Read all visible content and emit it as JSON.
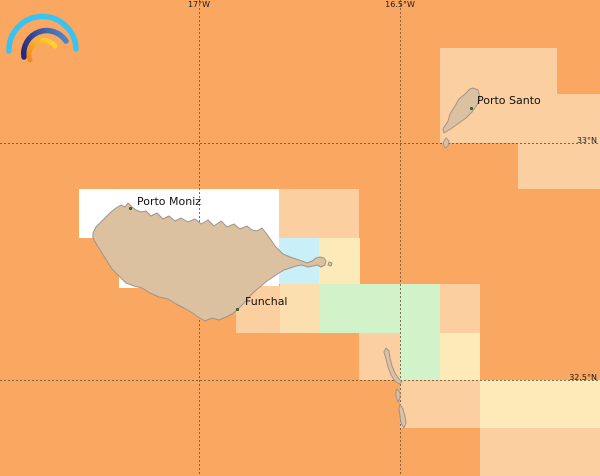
{
  "map": {
    "width": 600,
    "height": 476,
    "base_color": "#F9A761",
    "palette": {
      "peach": "#FBCFA0",
      "yellow": "#FCEBB8",
      "cream": "#FBDFAE",
      "cyan": "#C9F0F8",
      "green": "#D2F3CA",
      "white": "#FFFFFF",
      "base": "#F9A761"
    },
    "regions": [
      {
        "name": "tile-ne-block",
        "x": 440,
        "y": 48,
        "w": 160,
        "h": 95,
        "color": "peach"
      },
      {
        "name": "tile-ne-corner-notch",
        "x": 557,
        "y": 48,
        "w": 43,
        "h": 46,
        "color": "base"
      },
      {
        "name": "tile-east-mid",
        "x": 518,
        "y": 143,
        "w": 82,
        "h": 46,
        "color": "peach"
      },
      {
        "name": "tile-white-row1",
        "x": 79,
        "y": 189,
        "w": 200,
        "h": 49,
        "color": "white"
      },
      {
        "name": "tile-white-row2",
        "x": 119,
        "y": 238,
        "w": 160,
        "h": 50,
        "color": "white"
      },
      {
        "name": "tile-north-of-madeira",
        "x": 279,
        "y": 189,
        "w": 80,
        "h": 49,
        "color": "peach"
      },
      {
        "name": "tile-cyan-east-tip",
        "x": 279,
        "y": 238,
        "w": 40,
        "h": 46,
        "color": "cyan"
      },
      {
        "name": "tile-yellow-east-tip",
        "x": 319,
        "y": 238,
        "w": 41,
        "h": 46,
        "color": "yellow"
      },
      {
        "name": "tile-south-funchal",
        "x": 236,
        "y": 286,
        "w": 44,
        "h": 47,
        "color": "peach"
      },
      {
        "name": "tile-cream-southeast",
        "x": 280,
        "y": 284,
        "w": 40,
        "h": 49,
        "color": "cream"
      },
      {
        "name": "tile-green-1",
        "x": 320,
        "y": 284,
        "w": 80,
        "h": 49,
        "color": "green"
      },
      {
        "name": "tile-green-2",
        "x": 400,
        "y": 284,
        "w": 40,
        "h": 96,
        "color": "green"
      },
      {
        "name": "tile-peach-desertas",
        "x": 359,
        "y": 333,
        "w": 41,
        "h": 47,
        "color": "peach"
      },
      {
        "name": "tile-peach-east1",
        "x": 440,
        "y": 284,
        "w": 40,
        "h": 49,
        "color": "peach"
      },
      {
        "name": "tile-yellow-east2",
        "x": 440,
        "y": 333,
        "w": 40,
        "h": 47,
        "color": "yellow"
      },
      {
        "name": "tile-south-peach",
        "x": 400,
        "y": 380,
        "w": 80,
        "h": 48,
        "color": "peach"
      },
      {
        "name": "tile-south-yellow",
        "x": 480,
        "y": 380,
        "w": 120,
        "h": 48,
        "color": "yellow"
      },
      {
        "name": "tile-south-corner",
        "x": 480,
        "y": 428,
        "w": 120,
        "h": 48,
        "color": "peach"
      }
    ],
    "grid": {
      "meridians": [
        {
          "label": "17°W",
          "x": 199
        },
        {
          "label": "16.5°W",
          "x": 400
        }
      ],
      "parallels": [
        {
          "label": "33°N",
          "y": 143
        },
        {
          "label": "32.5°N",
          "y": 380
        }
      ]
    },
    "islands": {
      "fill": "#DCC1A1",
      "stroke": "#9E948A",
      "paths": [
        {
          "name": "madeira",
          "d": "M 93,233 L 96,227 101,222 106,217 111,212 116,208 121,205 125,207 128,203 132,207 136,210 141,212 146,211 151,216 157,213 163,219 169,216 175,221 181,218 188,222 195,219 201,224 208,220 214,226 221,221 227,227 234,224 240,229 247,226 252,230 257,231 262,228 266,233 271,240 275,246 279,250 283,254 290,257 296,259 302,261 307,263 312,261 316,258 320,257 324,258 326,261 325,265 321,267 317,265 313,266 308,267 302,265 296,266 290,268 284,270 279,273 273,277 267,281 261,286 255,291 250,296 245,302 241,306 237,310 232,314 226,317 219,320 212,318 205,321 198,317 191,312 184,308 176,304 168,299 159,297 150,293 142,288 134,286 126,283 119,276 112,269 107,261 102,253 97,245 93,238 Z"
        },
        {
          "name": "madeira-east-islet",
          "d": "M 329,262 L 332,263 331,266 328,265 Z"
        },
        {
          "name": "porto-santo",
          "d": "M 473,88 L 478,90 480,98 477,105 472,112 466,118 459,123 452,128 444,133 443,129 448,121 450,114 455,106 459,99 465,94 470,89 Z"
        },
        {
          "name": "porto-santo-islet",
          "d": "M 446,138 L 449,141 448,146 445,148 443,143 Z"
        },
        {
          "name": "desertas-north",
          "d": "M 386,348 L 389,351 390,358 392,366 395,373 399,379 402,382 399,384 395,381 391,375 388,367 386,359 384,352 Z"
        },
        {
          "name": "desertas-mid",
          "d": "M 397,389 L 400,393 400,398 398,402 396,396 396,391 Z"
        },
        {
          "name": "desertas-south",
          "d": "M 400,404 L 403,409 405,416 406,423 404,428 401,423 400,416 399,409 Z"
        }
      ]
    },
    "places": [
      {
        "name": "Porto Moniz",
        "dot_x": 131,
        "dot_y": 209,
        "label_x": 137,
        "label_y": 196
      },
      {
        "name": "Funchal",
        "dot_x": 238,
        "dot_y": 310,
        "label_x": 245,
        "label_y": 296
      },
      {
        "name": "Porto Santo",
        "dot_x": 472,
        "dot_y": 109,
        "label_x": 477,
        "label_y": 95
      }
    ],
    "logo": {
      "icon": "rainbow-icon",
      "arc_colors": {
        "outer": "#38C3F2",
        "middle_start": "#272775",
        "middle_end": "#4E83C4",
        "inner_start": "#F5891D",
        "inner_end": "#FFD02E"
      }
    }
  }
}
